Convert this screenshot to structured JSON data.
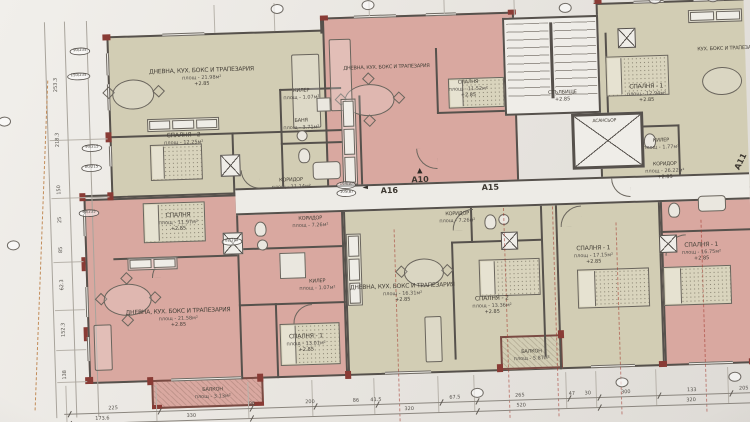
{
  "palette": {
    "paper": "#e9e6e1",
    "beige": "#d2cdb2",
    "pink": "#dca79e",
    "wall": "#56514b",
    "accent_red": "#8e3a33"
  },
  "rooms": {
    "tlLiving": {
      "name": "ДНЕВНА, КУХ. БОКС И ТРАПЕЗАРИЯ",
      "area": "площ - 21.98м²",
      "level": "+2.85"
    },
    "tlBedroom": {
      "name": "СПАЛНЯ - 2",
      "area": "площ - 12.25м²",
      "level": "+2.85"
    },
    "tlCloset": {
      "name": "КИЛЕР",
      "area": "площ - 1.07м²"
    },
    "tlBath": {
      "name": "БАНЯ",
      "area": "площ - 3.71м²"
    },
    "tlCorridor": {
      "name": "КОРИДОР",
      "area": "площ - 11.14м²"
    },
    "tcLiving": {
      "name": "ДНЕВНА, КУХ. БОКС И ТРАПЕЗАРИЯ"
    },
    "tcBedroom": {
      "name": "СПАЛНЯ",
      "area": "площ - 11.52м²",
      "level": "+2.85"
    },
    "blBedroom": {
      "name": "СПАЛНЯ",
      "area": "площ - 11.97м²",
      "level": "+2.85"
    },
    "blLiving": {
      "name": "ДНЕВНА, КУХ. БОКС И ТРАПЕЗАРИЯ",
      "area": "площ - 21.58м²",
      "level": "+2.85"
    },
    "blBalcony": {
      "name": "БАЛКОН",
      "area": "площ - 3.13м²"
    },
    "bcCorridor": {
      "name": "КОРИДОР",
      "area": "площ - 7.26м²"
    },
    "bcCloset": {
      "name": "КИЛЕР",
      "area": "площ - 1.07м²"
    },
    "bcBedroom": {
      "name": "СПАЛНЯ - 1",
      "area": "площ - 13.01м²",
      "level": "+2.85"
    },
    "a15Corridor": {
      "name": "КОРИДОР",
      "area": "площ - 7.26м²"
    },
    "a15Living": {
      "name": "ДНЕВНА, КУХ. БОКС И ТРАПЕЗАРИЯ",
      "area": "площ - 16.31м²",
      "level": "+2.85"
    },
    "a15Bedroom2": {
      "name": "СПАЛНЯ - 2",
      "area": "площ - 13.36м²",
      "level": "+2.85"
    },
    "a15Bedroom1": {
      "name": "СПАЛНЯ - 1",
      "area": "площ - 17.15м²",
      "level": "+2.85"
    },
    "a15Balcony": {
      "name": "БАЛКОН",
      "area": "площ - 5.87м²"
    },
    "rBedroom": {
      "name": "СПАЛНЯ - 1",
      "area": "площ - 16.75м²",
      "level": "+2.85"
    },
    "stairs": {
      "name": "СТЪЛБИЩЕ",
      "level": "+2.85"
    },
    "elevator": {
      "name": "АСАНСЬОР"
    },
    "trBedroom": {
      "name": "СПАЛНЯ - 1",
      "area": "площ - 12.94м²",
      "level": "+2.85"
    },
    "trCloset": {
      "name": "КИЛЕР",
      "area": "площ - 1.77м²"
    },
    "trLiving": {
      "name": "КУХ. БОКС И ТРАПЕЗАРИЯ"
    },
    "mainCorridor": {
      "name": "КОРИДОР",
      "area": "площ - 26.22м²",
      "level": "+2.85"
    }
  },
  "units": {
    "a10": "А10",
    "a15": "А15",
    "a16": "А16",
    "a11": "А11"
  },
  "icons": {
    "arrow_up": "▲",
    "arrow_left": "◄"
  },
  "tags": {
    "t1": "90/235",
    "t2": "150/235",
    "t3": "90/215",
    "t4": "80/215",
    "t5": "90/235",
    "t6": "82/202",
    "t7": "104(В)",
    "t8": "105(В)"
  },
  "dims": {
    "bottom1": [
      "225",
      "96",
      "200",
      "86",
      "41.5",
      "67.5",
      "265",
      "47",
      "30",
      "300",
      "133",
      "205"
    ],
    "bottom2": [
      "173.6",
      "330",
      "320",
      "520",
      "320"
    ],
    "left": [
      "253.3",
      "218.3",
      "150",
      "25",
      "85",
      "62.3",
      "152.3",
      "138"
    ]
  }
}
